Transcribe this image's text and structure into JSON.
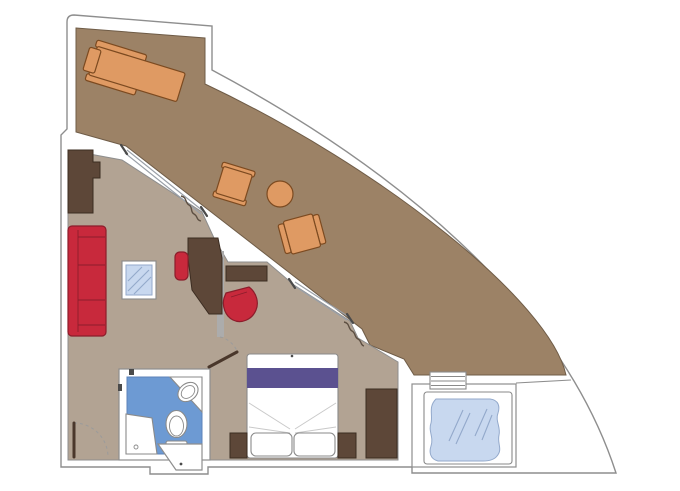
{
  "title": "suite-floor-plan",
  "colors": {
    "page_bg": "#ffffff",
    "wall_fill": "#ffffff",
    "wall_line": "#8e8e8e",
    "terrace_floor": "#9c8266",
    "terrace_line": "#6f5c47",
    "interior_floor": "#b2a393",
    "dark_wood": "#5d4738",
    "dark_wood_line": "#3b2c21",
    "upholstery_red": "#c8293c",
    "upholstery_red_line": "#8c1d2b",
    "rattan_orange": "#df9a63",
    "rattan_orange_line": "#7c4a20",
    "bed_runner_purple": "#5b5190",
    "bathroom_floor_blue": "#6d9ad3",
    "bathroom_floor_line": "#5d83b8",
    "water_glass_blue": "#c8d8ef",
    "water_glass_line": "#93a9cb",
    "fixture_line": "#8a8a8a",
    "partition_gray": "#acacac",
    "door_leaf_dark": "#4a372b",
    "swing_arc_gray": "#9b9b9b",
    "slider_line": "#9aa0a8",
    "frame_dark": "#4a4a4a",
    "curtain_line": "#5d4f42",
    "fold_line_gray": "#c9c9c9"
  },
  "rooms": [
    {
      "name": "terrace",
      "floor": "terrace_floor"
    },
    {
      "name": "living-room",
      "floor": "interior_floor"
    },
    {
      "name": "bedroom",
      "floor": "interior_floor"
    },
    {
      "name": "bathroom",
      "floor": "bathroom_floor_blue"
    },
    {
      "name": "whirlpool-deck",
      "floor": "wall_fill"
    }
  ],
  "furniture": {
    "terrace": [
      "double-sun-lounger",
      "armchair",
      "armchair",
      "round-side-table"
    ],
    "living_room": [
      "wardrobe",
      "sofa-3-seat",
      "glass-coffee-table",
      "desk",
      "desk-chair",
      "tub-chair"
    ],
    "bedroom": [
      "window-console",
      "double-bed",
      "pillow",
      "pillow",
      "nightstand",
      "nightstand",
      "wardrobe"
    ],
    "bathroom": [
      "vanity-counter",
      "sink",
      "toilet",
      "shower"
    ],
    "whirlpool_deck": [
      "whirlpool-tub",
      "steps"
    ]
  },
  "openings": [
    "entry-door",
    "bedroom-door",
    "sliding-glass-door-living",
    "sliding-glass-door-bedroom",
    "curtain",
    "curtain"
  ]
}
